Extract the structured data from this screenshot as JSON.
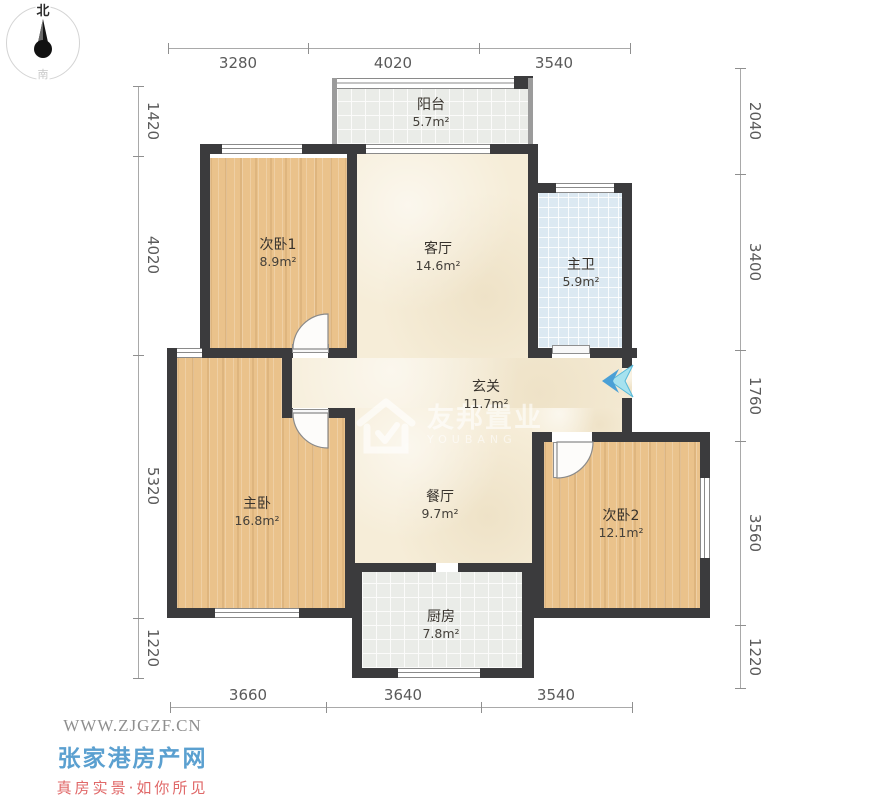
{
  "compass": {
    "north": "北",
    "south": "南"
  },
  "dimensions": {
    "top": [
      "3280",
      "4020",
      "3540"
    ],
    "bottom": [
      "3660",
      "3640",
      "3540"
    ],
    "left": [
      "1420",
      "4020",
      "5320",
      "1220"
    ],
    "right": [
      "2040",
      "3400",
      "1760",
      "3560",
      "1220"
    ]
  },
  "rooms": [
    {
      "name": "阳台",
      "area": "5.7m²"
    },
    {
      "name": "次卧1",
      "area": "8.9m²"
    },
    {
      "name": "客厅",
      "area": "14.6m²"
    },
    {
      "name": "主卫",
      "area": "5.9m²"
    },
    {
      "name": "玄关",
      "area": "11.7m²"
    },
    {
      "name": "主卧",
      "area": "16.8m²"
    },
    {
      "name": "餐厅",
      "area": "9.7m²"
    },
    {
      "name": "次卧2",
      "area": "12.1m²"
    },
    {
      "name": "厨房",
      "area": "7.8m²"
    }
  ],
  "watermark": {
    "brand": "友邦置业",
    "sub": "YOUBANG"
  },
  "branding": {
    "url": "WWW.ZJGZF.CN",
    "site": "张家港房产网",
    "slogan": "真房实景·如你所见"
  },
  "colors": {
    "wall": "#3b3b3d",
    "wood": "#eac28b",
    "cream": "#f6edd8",
    "tile_blue": "#dce9f2",
    "tile_gray": "#eaece8",
    "site_blue": "#5ba0d0",
    "slogan_red": "#e06868",
    "arrow_cyan": "#7fd4ea"
  }
}
